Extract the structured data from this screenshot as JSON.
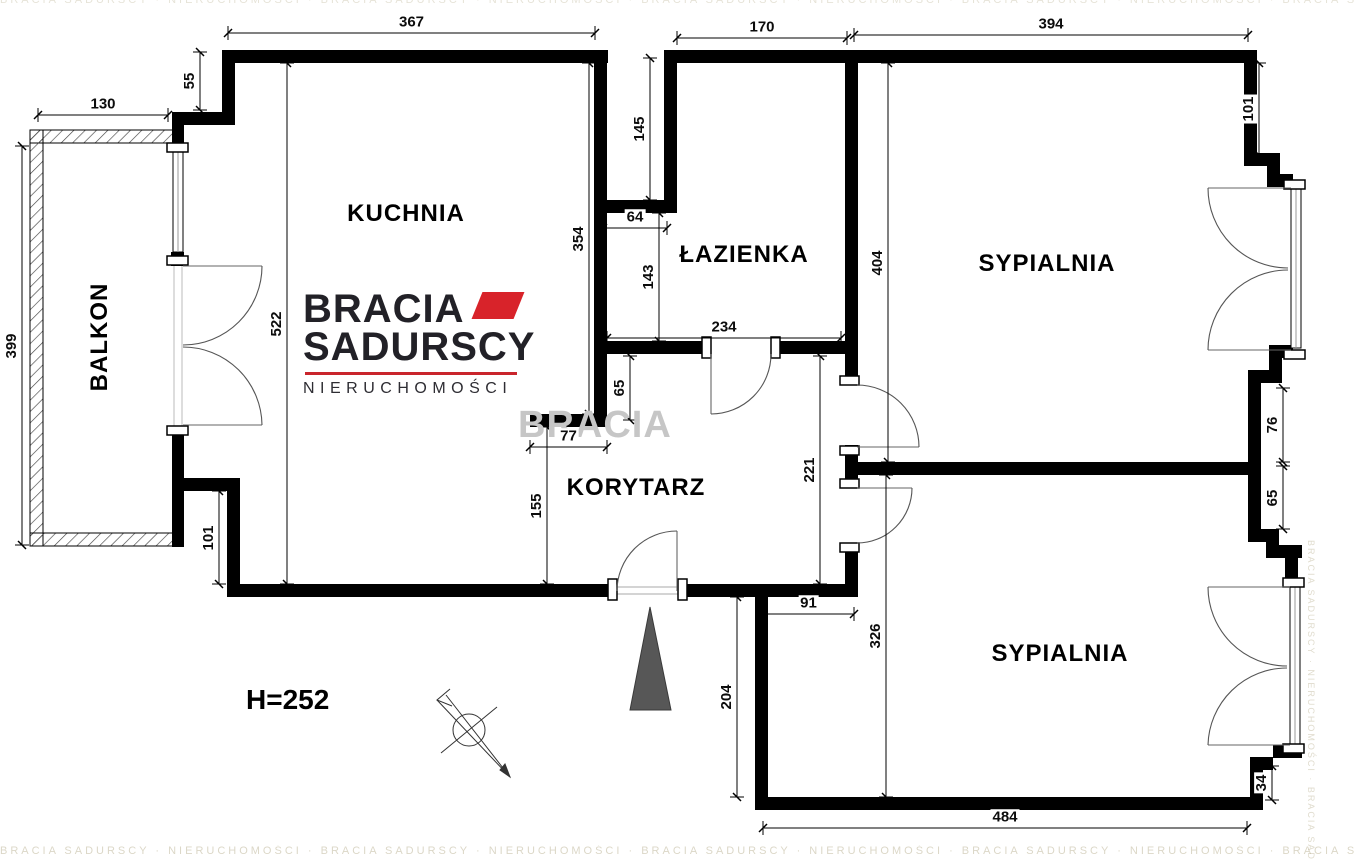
{
  "plan_title": "apartment floor plan",
  "logo": {
    "brand_line1": "BRACIA",
    "brand_line2": "SADURSCY",
    "brand_line3": "NIERUCHOMOŚCI"
  },
  "watermark": {
    "big": "BRACIA",
    "strip": "BRACIA SADURSCY · NIERUCHOMOŚCI · BRACIA SADURSCY · NIERUCHOMOŚCI · BRACIA SADURSCY · NIERUCHOMOŚCI · BRACIA SADURSCY · NIERUCHOMOŚCI · BRACIA SADURSCY"
  },
  "annotations": {
    "ceiling_height": "H=252"
  },
  "rooms": [
    {
      "label": "KUCHNIA",
      "x": 406,
      "y": 214,
      "rot": 0
    },
    {
      "label": "ŁAZIENKA",
      "x": 744,
      "y": 255,
      "rot": 0
    },
    {
      "label": "SYPIALNIA",
      "x": 1047,
      "y": 264,
      "rot": 0
    },
    {
      "label": "KORYTARZ",
      "x": 636,
      "y": 488,
      "rot": 0
    },
    {
      "label": "SYPIALNIA",
      "x": 1060,
      "y": 654,
      "rot": 0
    },
    {
      "label": "BALKON",
      "x": 100,
      "y": 337,
      "rot": -90
    }
  ],
  "dimensions": [
    {
      "v": "367",
      "o": "h",
      "x1": 228,
      "y1": 33,
      "x2": 595,
      "y2": 33
    },
    {
      "v": "130",
      "o": "h",
      "x1": 38,
      "y1": 115,
      "x2": 168,
      "y2": 115
    },
    {
      "v": "170",
      "o": "h",
      "x1": 677,
      "y1": 38,
      "x2": 847,
      "y2": 38
    },
    {
      "v": "394",
      "o": "h",
      "x1": 854,
      "y1": 35,
      "x2": 1248,
      "y2": 35
    },
    {
      "v": "64",
      "o": "h",
      "x1": 603,
      "y1": 228,
      "x2": 667,
      "y2": 228
    },
    {
      "v": "234",
      "o": "h",
      "x1": 607,
      "y1": 338,
      "x2": 841,
      "y2": 338
    },
    {
      "v": "77",
      "o": "h",
      "x1": 530,
      "y1": 447,
      "x2": 607,
      "y2": 447
    },
    {
      "v": "91",
      "o": "h",
      "x1": 763,
      "y1": 614,
      "x2": 854,
      "y2": 614
    },
    {
      "v": "484",
      "o": "h",
      "x1": 763,
      "y1": 828,
      "x2": 1247,
      "y2": 828
    },
    {
      "v": "55",
      "o": "v",
      "x1": 200,
      "y1": 52,
      "x2": 200,
      "y2": 110
    },
    {
      "v": "399",
      "o": "v",
      "x1": 22,
      "y1": 146,
      "x2": 22,
      "y2": 545
    },
    {
      "v": "522",
      "o": "v",
      "x1": 287,
      "y1": 63,
      "x2": 287,
      "y2": 584
    },
    {
      "v": "354",
      "o": "v",
      "x1": 589,
      "y1": 63,
      "x2": 589,
      "y2": 414
    },
    {
      "v": "145",
      "o": "v",
      "x1": 650,
      "y1": 58,
      "x2": 650,
      "y2": 200
    },
    {
      "v": "143",
      "o": "v",
      "x1": 659,
      "y1": 213,
      "x2": 659,
      "y2": 341
    },
    {
      "v": "404",
      "o": "v",
      "x1": 888,
      "y1": 63,
      "x2": 888,
      "y2": 462
    },
    {
      "v": "101",
      "o": "v",
      "x1": 1259,
      "y1": 63,
      "x2": 1259,
      "y2": 155
    },
    {
      "v": "76",
      "o": "v",
      "x1": 1283,
      "y1": 388,
      "x2": 1283,
      "y2": 462
    },
    {
      "v": "65",
      "o": "v",
      "x1": 1283,
      "y1": 466,
      "x2": 1283,
      "y2": 529
    },
    {
      "v": "65",
      "o": "v",
      "x1": 630,
      "y1": 356,
      "x2": 630,
      "y2": 420
    },
    {
      "v": "155",
      "o": "v",
      "x1": 547,
      "y1": 427,
      "x2": 547,
      "y2": 584
    },
    {
      "v": "221",
      "o": "v",
      "x1": 820,
      "y1": 356,
      "x2": 820,
      "y2": 584
    },
    {
      "v": "101",
      "o": "v",
      "x1": 219,
      "y1": 491,
      "x2": 219,
      "y2": 584
    },
    {
      "v": "326",
      "o": "v",
      "x1": 886,
      "y1": 475,
      "x2": 886,
      "y2": 797
    },
    {
      "v": "204",
      "o": "v",
      "x1": 737,
      "y1": 597,
      "x2": 737,
      "y2": 797
    },
    {
      "v": "34",
      "o": "v",
      "x1": 1272,
      "y1": 766,
      "x2": 1272,
      "y2": 800
    }
  ],
  "colors": {
    "wall": "#000000",
    "accent_red": "#d8232a",
    "entrance_triangle": "#575757",
    "watermark_gray": "#c6c6c6"
  }
}
